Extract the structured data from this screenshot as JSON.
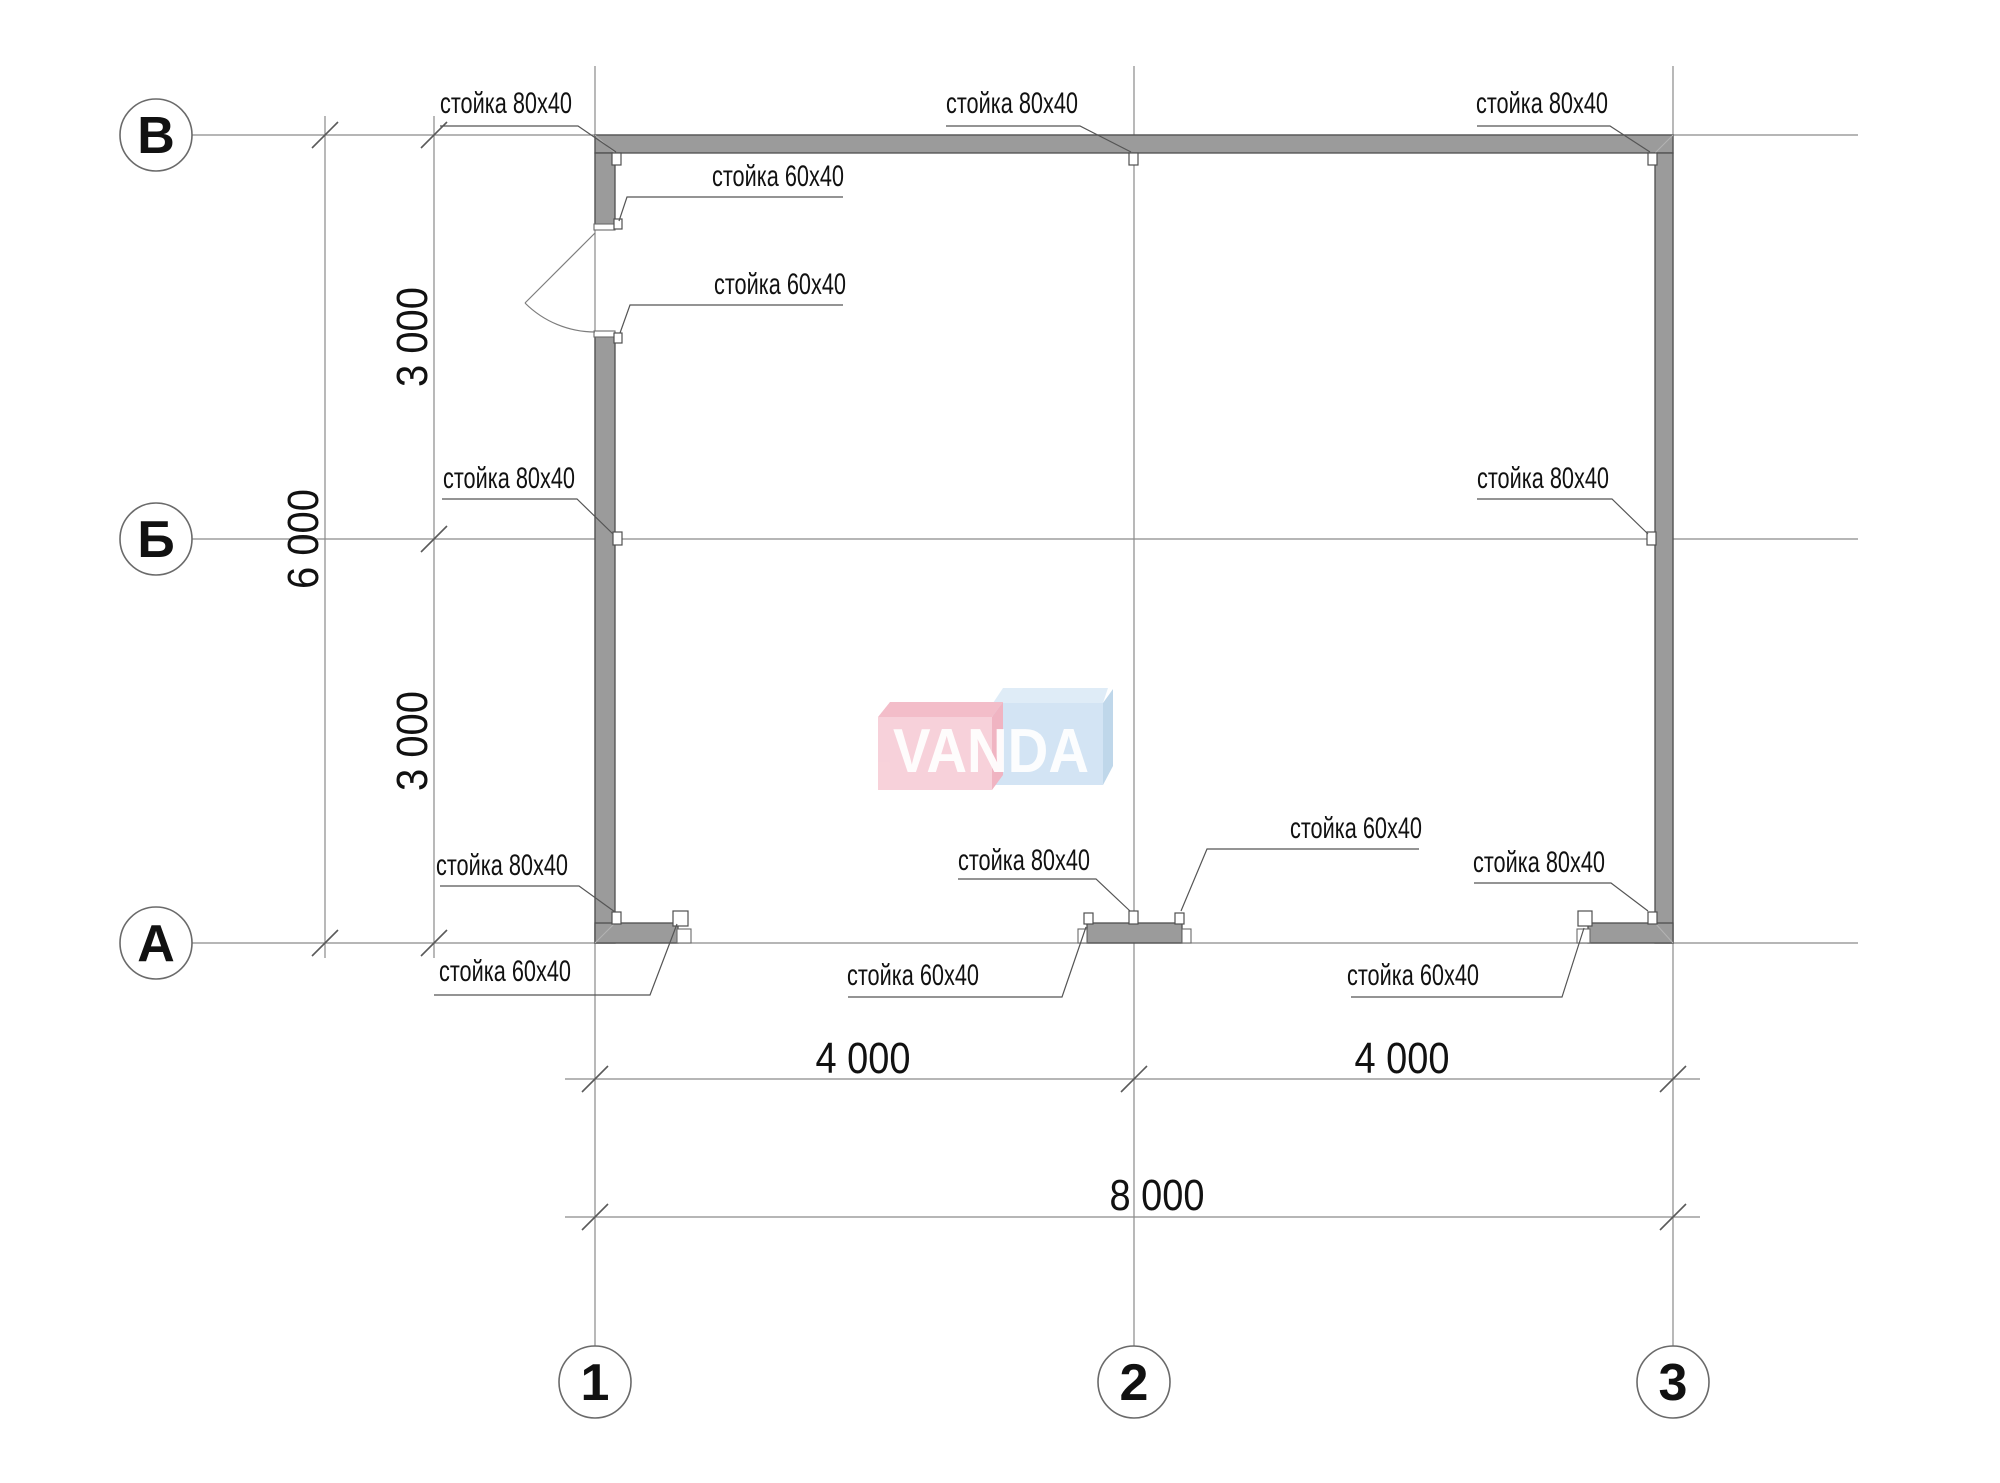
{
  "axes": {
    "rows": [
      {
        "label": "В"
      },
      {
        "label": "Б"
      },
      {
        "label": "А"
      }
    ],
    "cols": [
      {
        "label": "1"
      },
      {
        "label": "2"
      },
      {
        "label": "3"
      }
    ]
  },
  "dimensions": {
    "left_span_upper": "3 000",
    "left_span_lower": "3 000",
    "left_total": "6 000",
    "bottom_span_left": "4 000",
    "bottom_span_right": "4 000",
    "bottom_total": "8 000"
  },
  "post_labels": [
    {
      "name": "top-left-corner",
      "text": "стойка 80x40"
    },
    {
      "name": "top-center",
      "text": "стойка 80x40"
    },
    {
      "name": "top-right-corner",
      "text": "стойка 80x40"
    },
    {
      "name": "door-upper-jamb",
      "text": "стойка 60x40"
    },
    {
      "name": "door-lower-jamb",
      "text": "стойка 60x40"
    },
    {
      "name": "axis-b-left",
      "text": "стойка 80x40"
    },
    {
      "name": "axis-b-right",
      "text": "стойка 80x40"
    },
    {
      "name": "bottom-left-corner",
      "text": "стойка 80x40"
    },
    {
      "name": "bottom-left-end",
      "text": "стойка 60x40"
    },
    {
      "name": "bottom-mid-left",
      "text": "стойка 60x40"
    },
    {
      "name": "bottom-mid-center",
      "text": "стойка 80x40"
    },
    {
      "name": "bottom-mid-right",
      "text": "стойка 60x40"
    },
    {
      "name": "bottom-right-end",
      "text": "стойка 60x40"
    },
    {
      "name": "bottom-right-corner",
      "text": "стойка 80x40"
    }
  ],
  "watermark": {
    "text": "VANDA"
  },
  "colors": {
    "axis-line": "#8a8a8a",
    "tick-color": "#5a5a5a",
    "wall-fill": "#9b9b9b",
    "wall-stroke": "#4f4f4f",
    "leader-line": "#555555",
    "text-color": "#111111",
    "logo-pink-front": "#f7cdd6",
    "logo-pink-top": "#f2b6c4",
    "logo-pink-side": "#efacbc",
    "logo-blue-front": "#cfe2f3",
    "logo-blue-top": "#dcebf7",
    "logo-blue-side": "#b9d3e8",
    "logo-text": "#ffffff"
  }
}
